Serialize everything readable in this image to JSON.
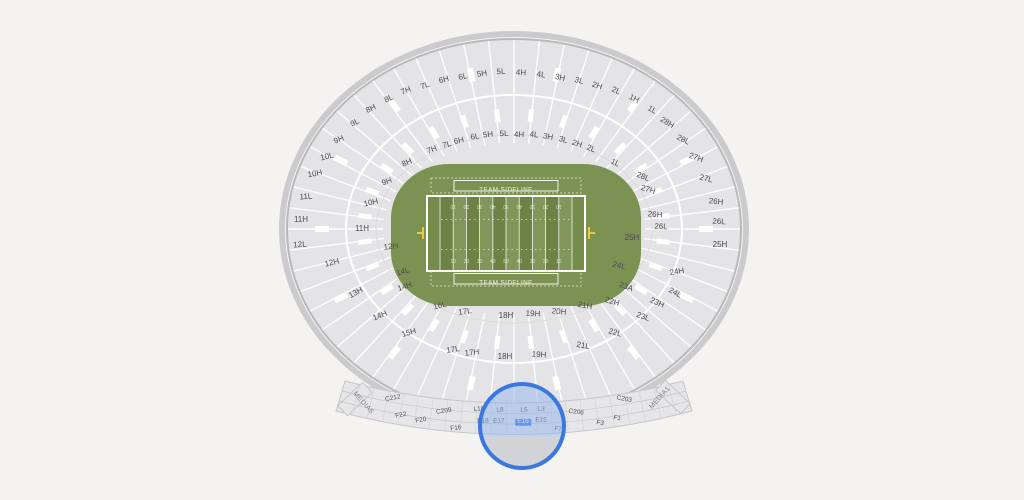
{
  "canvas": {
    "w": 1024,
    "h": 500,
    "bg": "#f4f3f1"
  },
  "stadium": {
    "cx": 514,
    "cy": 229,
    "outer_rx": 227,
    "outer_ry": 190,
    "mid_rx": 168,
    "mid_ry": 134,
    "inner_rx": 131,
    "inner_ry": 86,
    "sections": 56,
    "bowl_fill": "#e4e4e6",
    "rim_color": "#b9b9bb",
    "halo_color": "#cbcbcd",
    "divider_color": "#ffffff",
    "aisle_color": "#ffffff"
  },
  "field": {
    "grass": "#7c9252",
    "endzone": "#758c4b",
    "stripe_dark": "#6d8245",
    "stripe_light": "#81965a",
    "line_color": "#ffffff",
    "number_color": "#e9eddd",
    "goalpost_color": "#eec83e",
    "team_sideline_label": "TEAM SIDELINE",
    "yard_numbers": [
      "10",
      "20",
      "30",
      "40",
      "50",
      "40",
      "30",
      "20",
      "10"
    ]
  },
  "bottom_band": {
    "fill": "#e6e6e8",
    "line": "#c6c6c8",
    "tick": "#d2d2d4"
  },
  "labels": {
    "columns": [
      "label",
      "x",
      "y",
      "rotation"
    ],
    "ring": [
      [
        "7H",
        406,
        91,
        -22
      ],
      [
        "7L",
        425,
        86,
        -19
      ],
      [
        "6H",
        444,
        80,
        -16
      ],
      [
        "6L",
        463,
        77,
        -12
      ],
      [
        "5H",
        482,
        74,
        -8
      ],
      [
        "5L",
        501,
        72,
        -3
      ],
      [
        "4H",
        521,
        73,
        3
      ],
      [
        "4L",
        541,
        75,
        8
      ],
      [
        "3H",
        560,
        78,
        12
      ],
      [
        "3L",
        579,
        81,
        16
      ],
      [
        "2H",
        597,
        86,
        19
      ],
      [
        "2L",
        616,
        91,
        22
      ],
      [
        "1H",
        634,
        99,
        26
      ],
      [
        "1L",
        652,
        110,
        29
      ],
      [
        "28H",
        667,
        123,
        32
      ],
      [
        "28L",
        683,
        140,
        26
      ],
      [
        "27H",
        696,
        158,
        20
      ],
      [
        "27L",
        706,
        179,
        14
      ],
      [
        "26H",
        716,
        202,
        7
      ],
      [
        "26L",
        719,
        222,
        2
      ],
      [
        "25H",
        720,
        245,
        0
      ],
      [
        "24H",
        677,
        272,
        -10
      ],
      [
        "24L",
        675,
        293,
        28
      ],
      [
        "23H",
        657,
        303,
        24
      ],
      [
        "23L",
        643,
        317,
        20
      ],
      [
        "22L",
        615,
        333,
        16
      ],
      [
        "21L",
        583,
        346,
        10
      ],
      [
        "19H",
        539,
        355,
        4
      ],
      [
        "18H",
        505,
        357,
        0
      ],
      [
        "17H",
        472,
        353,
        -6
      ],
      [
        "17L",
        453,
        350,
        -9
      ],
      [
        "15H",
        409,
        333,
        -16
      ],
      [
        "14H",
        380,
        316,
        -22
      ],
      [
        "13H",
        356,
        293,
        -28
      ],
      [
        "12H",
        332,
        263,
        -14
      ],
      [
        "12L",
        300,
        245,
        -4
      ],
      [
        "11H",
        301,
        220,
        0
      ],
      [
        "11L",
        306,
        197,
        -4
      ],
      [
        "10H",
        315,
        174,
        -10
      ],
      [
        "10L",
        327,
        157,
        -14
      ],
      [
        "9H",
        339,
        140,
        -22
      ],
      [
        "9L",
        355,
        123,
        -26
      ],
      [
        "8H",
        371,
        109,
        -28
      ],
      [
        "8L",
        389,
        99,
        -26
      ],
      [
        "8H",
        407,
        163,
        -24
      ],
      [
        "7H",
        432,
        150,
        -20
      ],
      [
        "7L",
        447,
        145,
        -16
      ],
      [
        "6H",
        459,
        141,
        -13
      ],
      [
        "6L",
        475,
        137,
        -9
      ],
      [
        "5H",
        488,
        135,
        -5
      ],
      [
        "5L",
        504,
        134,
        -2
      ],
      [
        "4H",
        519,
        135,
        2
      ],
      [
        "4L",
        534,
        135,
        6
      ],
      [
        "3H",
        548,
        137,
        10
      ],
      [
        "3L",
        563,
        140,
        14
      ],
      [
        "2H",
        577,
        144,
        18
      ],
      [
        "2L",
        591,
        149,
        21
      ],
      [
        "1L",
        615,
        163,
        26
      ],
      [
        "28L",
        643,
        177,
        22
      ],
      [
        "27H",
        648,
        190,
        18
      ],
      [
        "26H",
        655,
        215,
        6
      ],
      [
        "26L",
        661,
        227,
        2
      ],
      [
        "25H",
        632,
        238,
        0
      ],
      [
        "24L",
        619,
        266,
        14
      ],
      [
        "23A",
        626,
        287,
        20
      ],
      [
        "22H",
        612,
        302,
        16
      ],
      [
        "21H",
        585,
        306,
        10
      ],
      [
        "20H",
        559,
        312,
        6
      ],
      [
        "19H",
        533,
        314,
        3
      ],
      [
        "18H",
        506,
        316,
        0
      ],
      [
        "17L",
        465,
        312,
        -8
      ],
      [
        "16L",
        440,
        306,
        -14
      ],
      [
        "14H",
        405,
        287,
        -20
      ],
      [
        "14L",
        403,
        272,
        -16
      ],
      [
        "12H",
        391,
        247,
        -6
      ],
      [
        "11H",
        362,
        229,
        0
      ],
      [
        "10H",
        371,
        203,
        -12
      ],
      [
        "9H",
        387,
        182,
        -20
      ]
    ],
    "bottom": [
      [
        "C212",
        393,
        399,
        -10
      ],
      [
        "F22",
        401,
        416,
        -11
      ],
      [
        "F20",
        421,
        421,
        -9
      ],
      [
        "C209",
        444,
        412,
        -8
      ],
      [
        "F16",
        456,
        429,
        -7
      ],
      [
        "L10",
        479,
        410,
        -4
      ],
      [
        "L8",
        500,
        411,
        -2
      ],
      [
        "L5",
        524,
        411,
        1
      ],
      [
        "L3",
        541,
        410,
        3
      ],
      [
        "E18",
        483,
        422,
        -3
      ],
      [
        "E17",
        499,
        422,
        -2
      ],
      [
        "E16",
        523,
        422,
        0
      ],
      [
        "E15",
        541,
        421,
        2
      ],
      [
        "C206",
        576,
        413,
        7
      ],
      [
        "F7",
        558,
        430,
        7
      ],
      [
        "F3",
        600,
        424,
        9
      ],
      [
        "F1",
        617,
        419,
        11
      ],
      [
        "C203",
        624,
        400,
        11
      ]
    ],
    "media": [
      [
        "MEDIA6",
        363,
        403,
        48
      ],
      [
        "MEDIA1",
        660,
        398,
        -48
      ]
    ]
  },
  "magnifier": {
    "cx": 522,
    "cy": 426,
    "r": 44,
    "ring_color": "#3a78e0",
    "tint": "rgba(145,180,236,0.5)",
    "lower_fill": "#d2d3d6",
    "tint_split_pct": 63,
    "highlight_section": "E16",
    "highlight_color": "#3c7ce2"
  }
}
